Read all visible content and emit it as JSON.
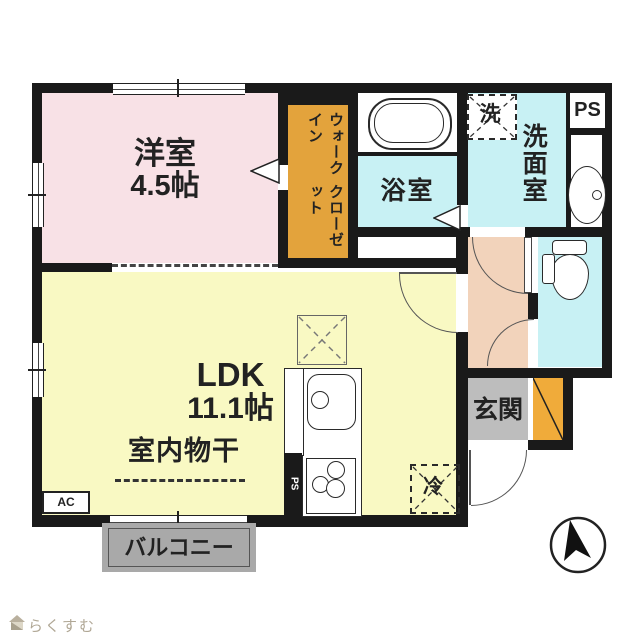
{
  "rooms": {
    "western": {
      "label": "洋室",
      "area": "4.5帖"
    },
    "ldk": {
      "label": "LDK",
      "area": "11.1帖"
    },
    "wic": {
      "line1": "ウォークイン",
      "line2": "クローゼット"
    },
    "bath": {
      "label": "浴室"
    },
    "washroom": {
      "label": "洗面室"
    },
    "entrance": {
      "label": "玄関"
    },
    "balcony": {
      "label": "バルコニー"
    },
    "indoor_drying": {
      "label": "室内物干"
    }
  },
  "equipment": {
    "washer_mark": "洗",
    "fridge_mark": "冷",
    "ac_mark": "AC",
    "ps_top": "PS",
    "ps_kitchen": "PS"
  },
  "watermark": {
    "brand": "らくすむ"
  },
  "colors": {
    "wall": "#1a1a1a",
    "western_room": "#f8e1e6",
    "ldk": "#f9f9c3",
    "wic": "#e3a33c",
    "shoe_cabinet": "#f0ab3a",
    "wet_rooms": "#c8f1f4",
    "hallway": "#f2d3bb",
    "entrance_floor": "#bdbdbd",
    "balcony": "#a9a9a9"
  }
}
